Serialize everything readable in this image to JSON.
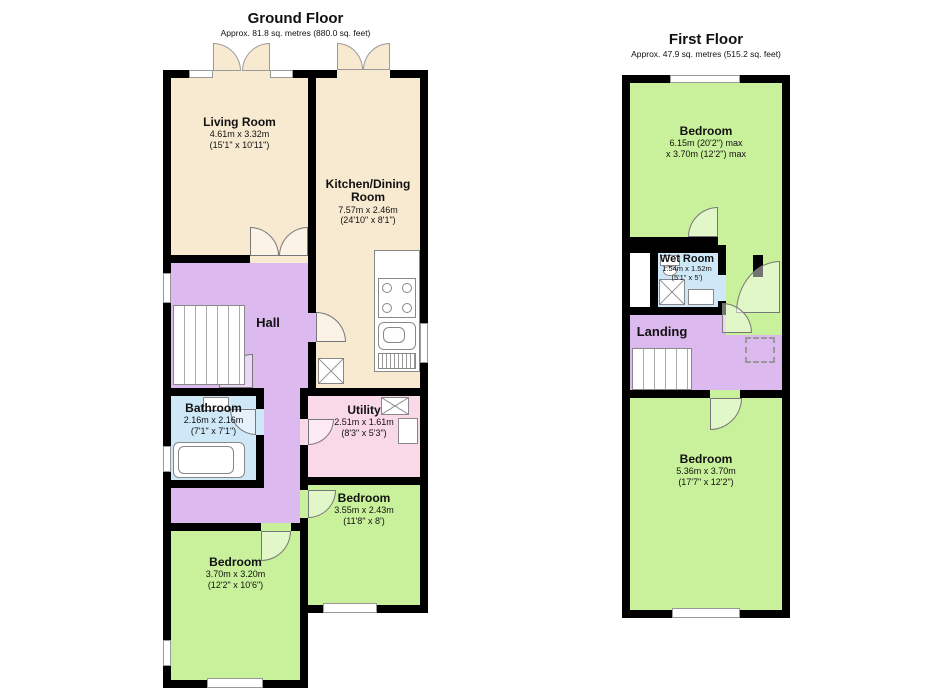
{
  "palette": {
    "wall": "#000000",
    "living_kitchen": "#F8EAD1",
    "bedroom": "#C9F09A",
    "hall_landing": "#DCB9EE",
    "bathroom_wetroom": "#CFE8F7",
    "utility": "#F9D8E8",
    "background": "#FFFFFF"
  },
  "ground_floor": {
    "title": "Ground Floor",
    "subtitle": "Approx. 81.8 sq. metres (880.0 sq. feet)",
    "rooms": {
      "living_room": {
        "name": "Living Room",
        "dims1": "4.61m x 3.32m",
        "dims2": "(15'1\" x 10'11\")"
      },
      "kitchen_dining": {
        "name": "Kitchen/Dining Room",
        "dims1": "7.57m x 2.46m",
        "dims2": "(24'10\" x 8'1\")"
      },
      "hall": {
        "name": "Hall"
      },
      "bathroom": {
        "name": "Bathroom",
        "dims1": "2.16m x 2.16m",
        "dims2": "(7'1\" x 7'1\")"
      },
      "utility": {
        "name": "Utility",
        "dims1": "2.51m x 1.61m",
        "dims2": "(8'3\" x 5'3\")"
      },
      "bedroom_rear": {
        "name": "Bedroom",
        "dims1": "3.55m x 2.43m",
        "dims2": "(11'8\" x 8')"
      },
      "bedroom_front": {
        "name": "Bedroom",
        "dims1": "3.70m x 3.20m",
        "dims2": "(12'2\" x 10'6\")"
      }
    }
  },
  "first_floor": {
    "title": "First Floor",
    "subtitle": "Approx. 47.9 sq. metres (515.2 sq. feet)",
    "rooms": {
      "bedroom_top": {
        "name": "Bedroom",
        "dims1": "6.15m (20'2\") max",
        "dims2": "x 3.70m (12'2\") max"
      },
      "wet_room": {
        "name": "Wet Room",
        "dims1": "1.54m x 1.52m",
        "dims2": "(5'1\" x 5')"
      },
      "landing": {
        "name": "Landing"
      },
      "bedroom_bottom": {
        "name": "Bedroom",
        "dims1": "5.36m x 3.70m",
        "dims2": "(17'7\" x 12'2\")"
      }
    }
  }
}
